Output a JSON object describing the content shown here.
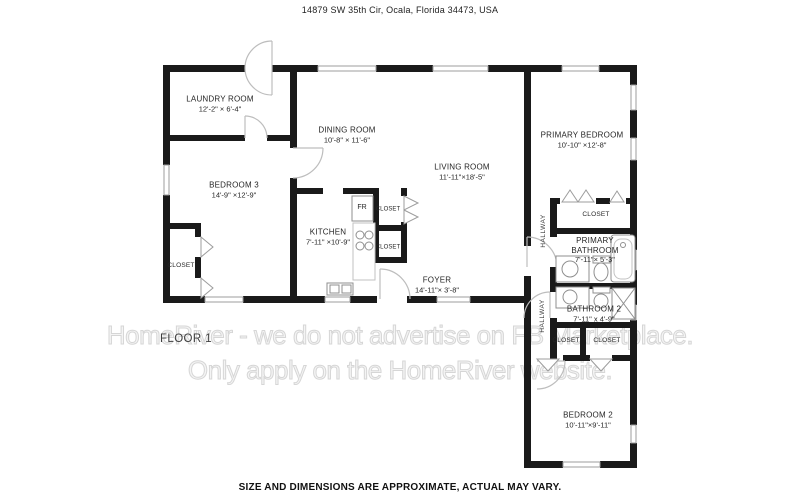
{
  "header": {
    "address": "14879 SW 35th Cir, Ocala, Florida 34473, USA"
  },
  "footer": {
    "disclaimer": "SIZE AND DIMENSIONS ARE APPROXIMATE, ACTUAL MAY VARY."
  },
  "watermark": {
    "line1": "HomeRiver - we do not advertise on FB Marketplace.",
    "line2": "Only apply on the HomeRiver website."
  },
  "plan": {
    "floor_label": "FLOOR 1",
    "labels": {
      "closet": "CLOSET",
      "hallway": "HALLWAY",
      "fridge": "FR"
    },
    "rooms": {
      "laundry": {
        "name": "LAUNDRY ROOM",
        "dims": "12'-2\" × 6'-4\""
      },
      "dining": {
        "name": "DINING ROOM",
        "dims": "10'-8\" × 11'-6\""
      },
      "living": {
        "name": "LIVING ROOM",
        "dims": "11'-11\"×18'-5\""
      },
      "bedroom3": {
        "name": "BEDROOM 3",
        "dims": "14'-9\" ×12'-9\""
      },
      "kitchen": {
        "name": "KITCHEN",
        "dims": "7'-11\" ×10'-9\""
      },
      "foyer": {
        "name": "FOYER",
        "dims": "14'-11\"× 3'-8\""
      },
      "primary_bedroom": {
        "name": "PRIMARY BEDROOM",
        "dims": "10'-10\" ×12'-8\""
      },
      "primary_bathroom": {
        "name": "PRIMARY BATHROOM",
        "dims": "7'-11\"× 5'-3\""
      },
      "bathroom2": {
        "name": "BATHROOM 2",
        "dims": "7'-11\" x 4'-9\""
      },
      "bedroom2": {
        "name": "BEDROOM 2",
        "dims": "10'-11\"×9'-11\""
      }
    }
  }
}
